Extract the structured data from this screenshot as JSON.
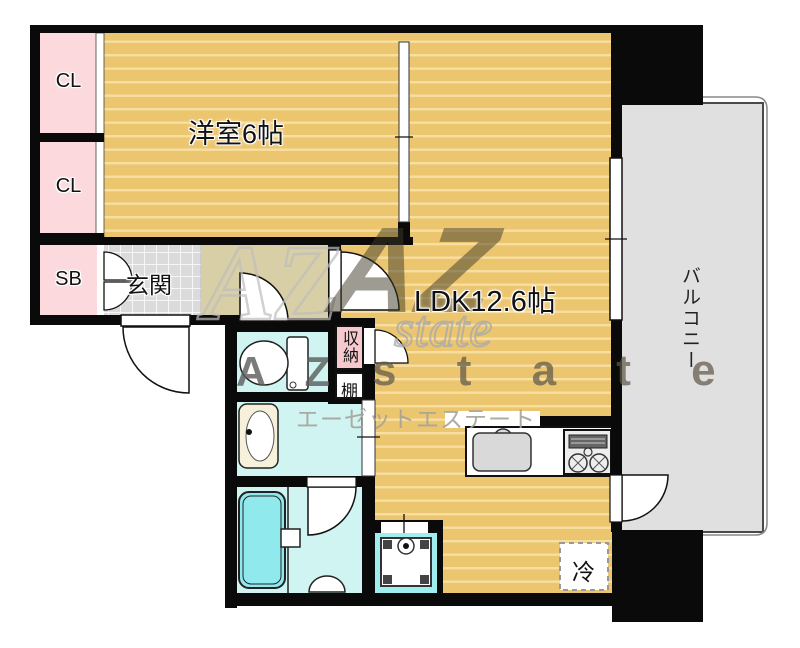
{
  "floorplan": {
    "rooms": {
      "closet1": "CL",
      "closet2": "CL",
      "shoe_box": "SB",
      "western_room": "洋室6帖",
      "ldk": "LDK12.6帖",
      "balcony": "バルコニー",
      "entrance": "玄関",
      "storage": "収納",
      "shelf": "棚",
      "refrigerator": "冷"
    },
    "watermark": {
      "outline_letters": "AZ",
      "logo_letters": "AZ",
      "script_word": "state",
      "letters_az": "A Z",
      "letters_state": "s t a t e",
      "katakana": "エーゼットエステート"
    },
    "colors": {
      "wall": "#0a0a0a",
      "wood_floor": "#ECC56F",
      "wood_stripe": "#F6DFA0",
      "closet_pink": "#FBD9DC",
      "corridor_beige": "#D9CFA6",
      "tile_gray": "#DBDBDB",
      "wet_room_cyan": "#CFF4F2",
      "tub_cyan": "#8FE9ED",
      "balcony_gray": "#E0E0E0"
    }
  }
}
